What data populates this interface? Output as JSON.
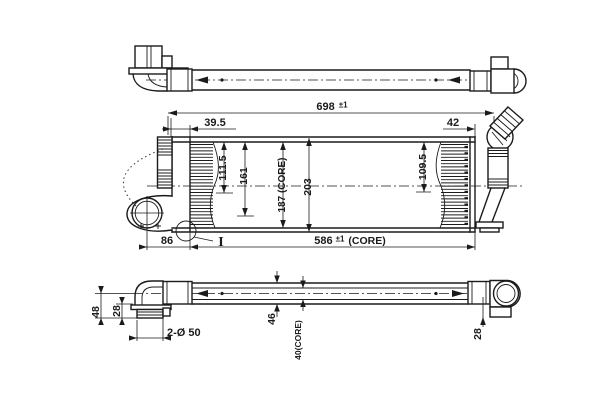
{
  "drawing": {
    "type": "technical-orthographic-drawing",
    "subject": "intercooler with inlet and outlet pipes, three views (top pipe view, front core view, bottom pipe view)",
    "colors": {
      "background": "#ffffff",
      "ink": "#1b1b1b"
    },
    "labels": {
      "overall_length": "698",
      "overall_length_tol": "±1",
      "left_inset": "39.5",
      "right_inset": "42",
      "upper_left_height": "111.5",
      "mid_left_height": "161",
      "core_height": "187 (CORE)",
      "overall_height": "203",
      "upper_right_height": "109.5",
      "port_to_core": "86",
      "core_length": "586",
      "core_length_tol": "±1",
      "core_length_suffix": "(CORE)",
      "detail_marker": "I",
      "drop_height": "48",
      "stub_drop": "28",
      "port_diameter": "2-Ø 50",
      "body_depth": "46",
      "core_depth": "40(CORE)",
      "right_stub_drop": "28"
    }
  }
}
